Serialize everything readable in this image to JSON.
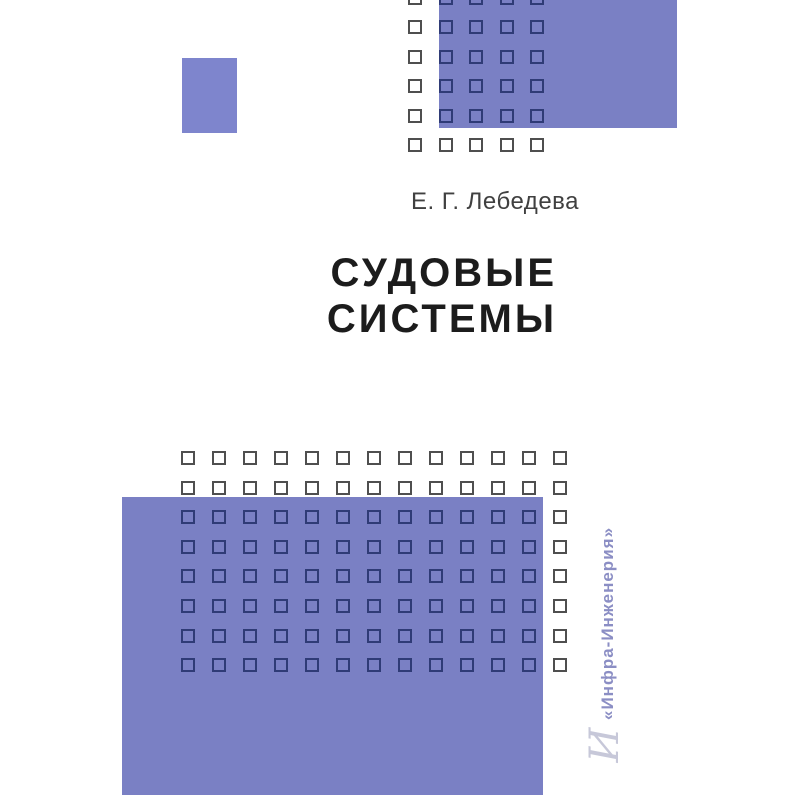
{
  "cover": {
    "author": "Е. Г. Лебедева",
    "title_line1": "СУДОВЫЕ",
    "title_line2": "СИСТЕМЫ",
    "publisher": "«Инфра-Инженерия»",
    "logo_glyph": "И"
  },
  "colors": {
    "periwinkle": "#7a80c4",
    "periwinkle_light": "#7e85cd",
    "square_border_on_white": "#4f4f4f",
    "square_border_on_purple": "#2f3b76",
    "title_color": "#1c1c1c",
    "author_color": "#404040",
    "publisher_color": "#8b8ec4",
    "logo_color": "#c7c8d9",
    "page_background": "#ffffff"
  },
  "decor": {
    "grid_top": {
      "cols": 5,
      "rows": 6,
      "x0": 408,
      "y0": -9,
      "dx": 30.5,
      "dy": 29.4,
      "size": 14
    },
    "grid_bottom": {
      "cols": 13,
      "rows": 8,
      "x0": 181,
      "y0": 451,
      "dx": 31,
      "dy": 29.6,
      "size": 14
    },
    "rect_top": {
      "x": 439,
      "y": -10,
      "w": 238,
      "h": 138
    },
    "rect_bottom": {
      "x": 122,
      "y": 497,
      "w": 421,
      "h": 298
    }
  }
}
